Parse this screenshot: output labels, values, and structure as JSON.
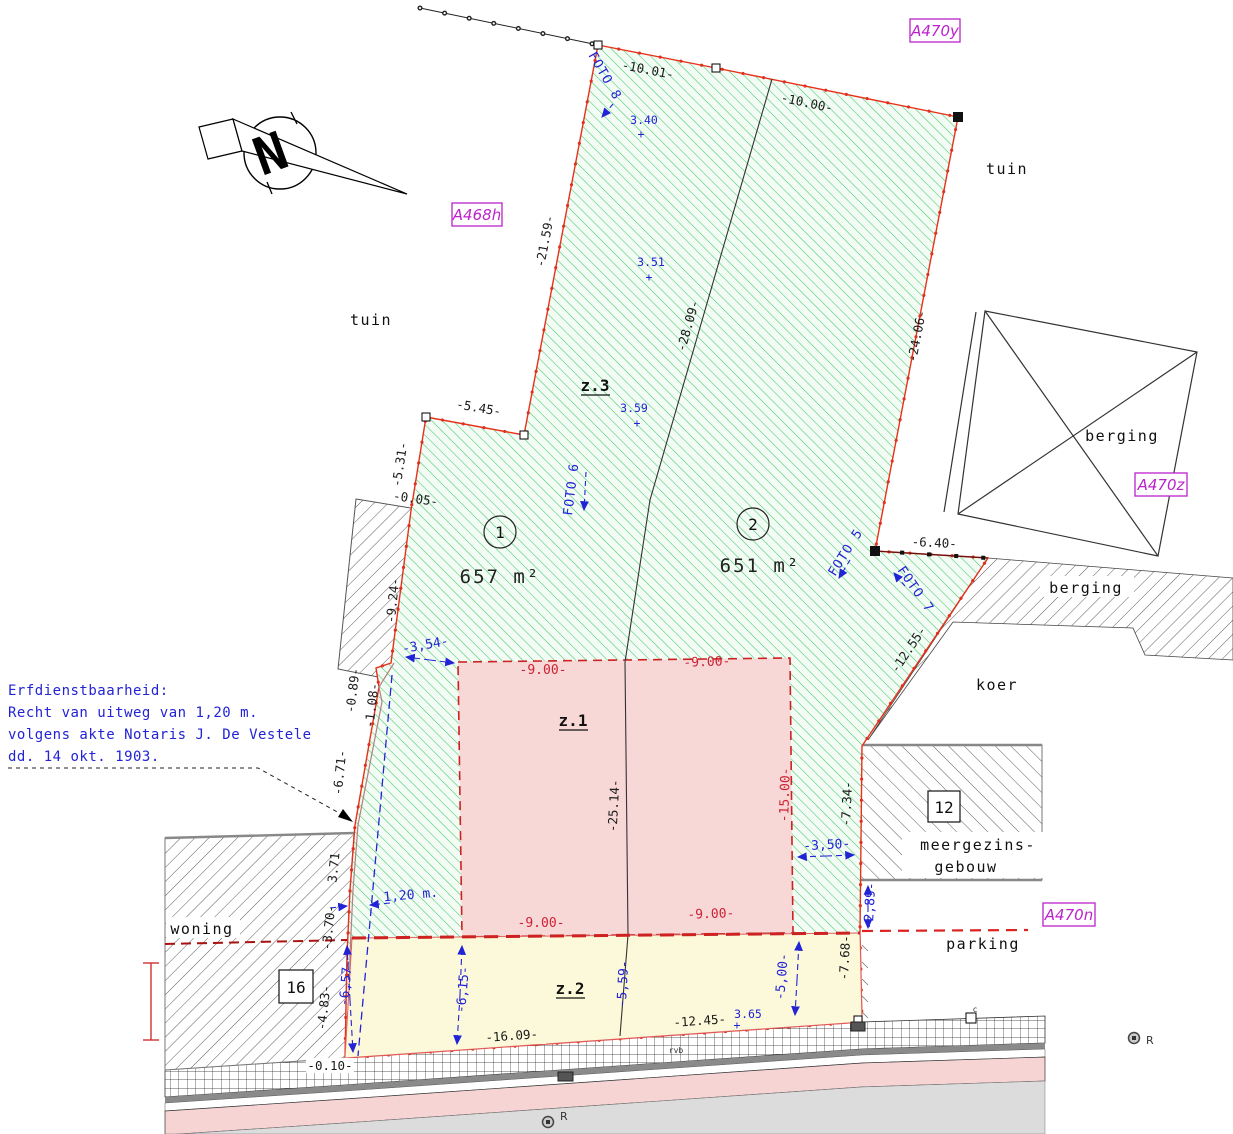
{
  "north_letter": "N",
  "refs": {
    "top_right": "A470y",
    "mid_left": "A468h",
    "right": "A470z",
    "bottom_right": "A470n"
  },
  "places": {
    "tuin_left": "tuin",
    "tuin_right": "tuin",
    "berging_building": "berging",
    "berging_strip": "berging",
    "koer": "koer",
    "woning": "woning",
    "parking": "parking",
    "meergezins_line1": "meergezins-",
    "meergezins_line2": "gebouw"
  },
  "house_numbers": {
    "left": "16",
    "right": "12"
  },
  "parcels": {
    "p1": {
      "num": "1",
      "area": "657 m²"
    },
    "p2": {
      "num": "2",
      "area": "651 m²"
    }
  },
  "zones": {
    "z1": "z.1",
    "z2": "z.2",
    "z3": "z.3"
  },
  "servitude_note": {
    "line1": "Erfdienstbaarheid:",
    "line2": "Recht van uitweg van 1,20 m.",
    "line3": "volgens akte Notaris J. De Vestele",
    "line4": "dd. 14 okt. 1903."
  },
  "dims_black": {
    "top_left_seg": "-10.01-",
    "top_right_seg": "-10.00-",
    "nw_edge": "-21.59-",
    "divider_upper": "-28.09-",
    "ne_edge": "-24.06-",
    "jog_545": "-5.45-",
    "jog_531": "-5.31-",
    "jog_005": "-0.05-",
    "west_924": "-9.24-",
    "west_089": "-0.89-",
    "west_108": "-1.08-",
    "west_671": "-6.71-",
    "west_371": "3.71",
    "west_370": "-3.70-",
    "west_483": "-4.83-",
    "east_640": "-6.40-",
    "east_1255": "-12.55-",
    "east_734": "-7.34-",
    "east_768": "-7.68-",
    "south_1609": "-16.09-",
    "south_1245": "-12.45-",
    "south_010": "-0.10-",
    "divider_z1": "-25.14-"
  },
  "dims_red": {
    "z1_top_left": "-9.00-",
    "z1_top_right": "-9.00-",
    "z1_bottom_left": "-9.00-",
    "z1_bottom_right": "-9.00-",
    "z1_right": "-15.00-"
  },
  "dims_blue": {
    "d354": "-3,54-",
    "d120": "1,20 m.",
    "d657": "-6,57-",
    "d615": "-6,15-",
    "d559": "-5,59-",
    "d500": "-5,00-",
    "d350": "-3,50-",
    "d289": "-2,89-"
  },
  "elevations": {
    "e1": "3.40",
    "e2": "3.51",
    "e3": "3.59",
    "e4": "3.65"
  },
  "photos": {
    "f8": "FOTO 8",
    "f6": "FOTO 6",
    "f5": "FOTO 5",
    "f7": "FOTO 7"
  },
  "survey_marks": {
    "r1": "R",
    "r2": "R",
    "c_mark": "c",
    "rvb": "rvb"
  },
  "colors": {
    "parcel_hatch_green": "#46c86a",
    "boundary_red": "#e8311a",
    "zone1_fill": "#f8d7d7",
    "zone2_fill": "#fbf9da",
    "dashed_red": "#cc2222",
    "measure_blue": "#2323d6",
    "ref_purple": "#bb22cc",
    "road_pink": "#f7d4d4",
    "band_gray": "#dcdcdc"
  }
}
